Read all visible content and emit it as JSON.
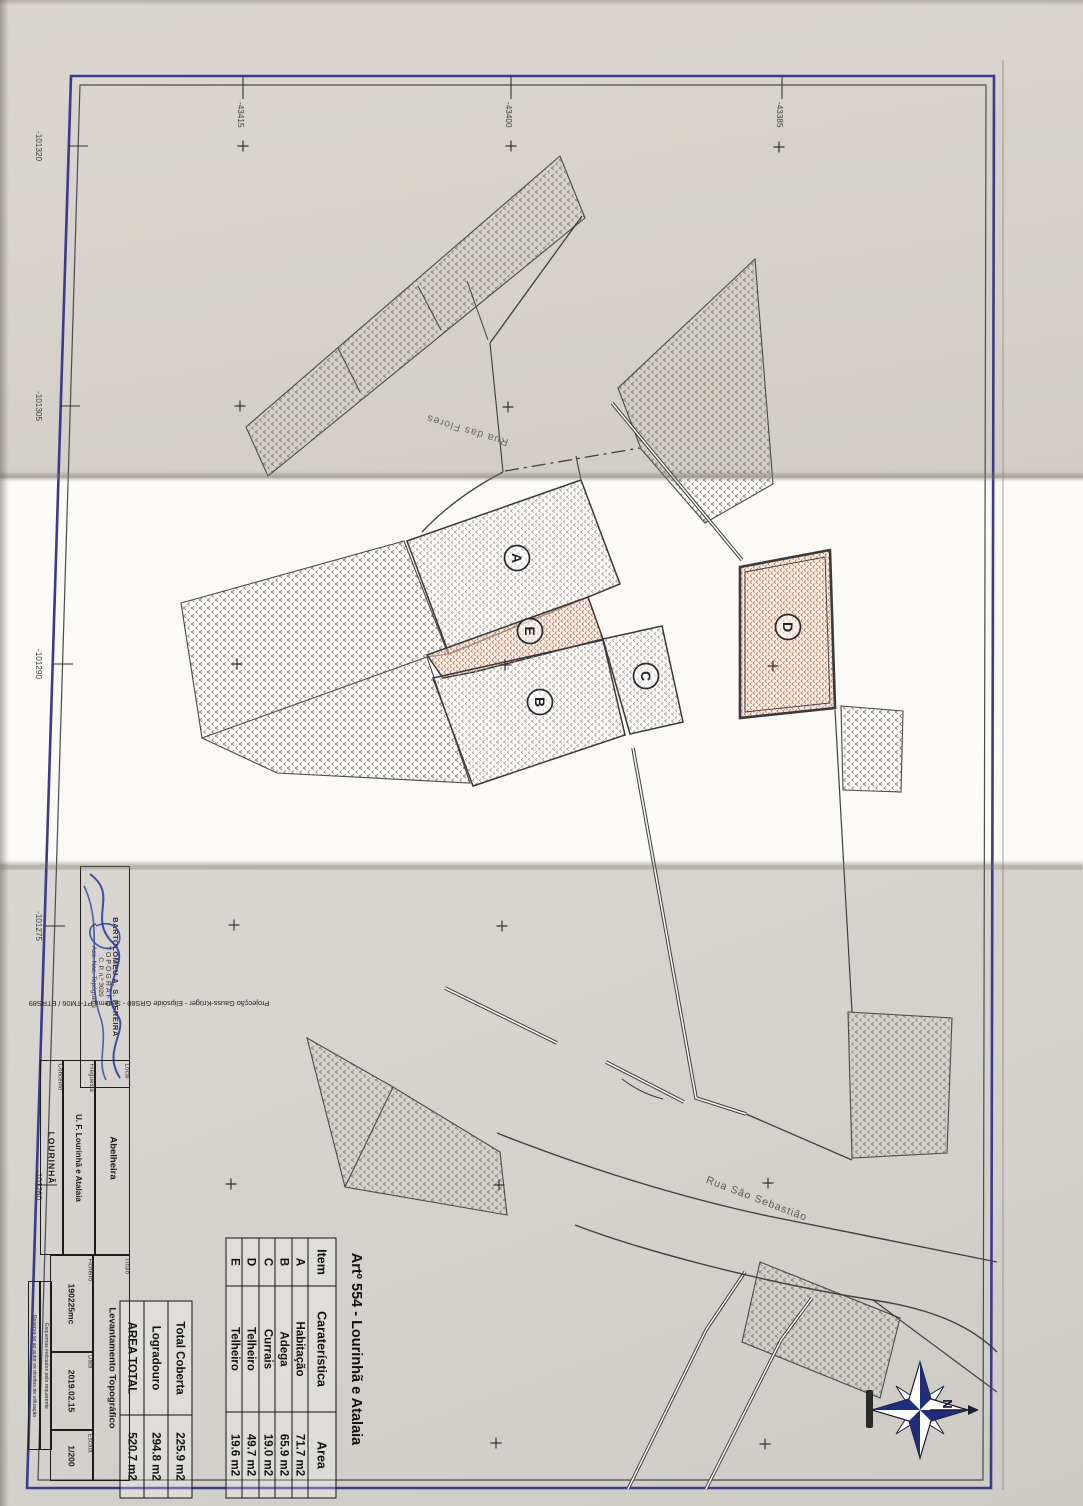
{
  "scan": {
    "plan_title": "Artº 554 - Lourinhã e Atalaia",
    "grid": {
      "left_labels": [
        "-101320",
        "-101305",
        "-101290",
        "-101275",
        "-101260"
      ],
      "top_labels": [
        "-43415",
        "-43400",
        "-43385"
      ]
    },
    "streets": {
      "flores": "Rua das Flores",
      "sebastiao": "Rua São Sebastião"
    },
    "building_labels": {
      "a": "A",
      "b": "B",
      "c": "C",
      "d": "D",
      "e": "E"
    },
    "compass": {
      "north_label": "N"
    }
  },
  "area_table": {
    "headers": {
      "item": "Item",
      "caracteristica": "Caraterística",
      "area": "Area"
    },
    "rows": [
      {
        "item": "A",
        "caracteristica": "Habitação",
        "area": "71.7 m2"
      },
      {
        "item": "B",
        "caracteristica": "Adega",
        "area": "65.9 m2"
      },
      {
        "item": "C",
        "caracteristica": "Currais",
        "area": "19.0 m2"
      },
      {
        "item": "D",
        "caracteristica": "Telheiro",
        "area": "49.7 m2"
      },
      {
        "item": "E",
        "caracteristica": "Telheiro",
        "area": "19.6 m2"
      }
    ],
    "summary": [
      {
        "label": "Total Coberta",
        "value": "225.9 m2"
      },
      {
        "label": "Logradouro",
        "value": "294.8 m2"
      },
      {
        "label": "AREA TOTAL",
        "value": "520.7 m2"
      }
    ]
  },
  "title_block": {
    "stamp": {
      "name": "BARTOLOMEU A. S. PEREIRA",
      "role": "TOPÓGRAFO",
      "number": "C. P. n.º 3029",
      "org": "Ass. Nac. Topógrafos"
    },
    "projection_note": "Projecção Gauss-Krüger - Elipsóide GRS80 - Sistema PT-TM06 / ETRS89",
    "fields": {
      "local": {
        "label": "Local",
        "value": "Abelheira"
      },
      "freguesia": {
        "label": "Freguesia",
        "value": "U. F. Lourinhã e Atalaia"
      },
      "concelho": {
        "label": "Concelho",
        "value": "LOURINHÃ"
      },
      "titulo": {
        "label": "Título",
        "value": "Levantamento Topográfico"
      },
      "ficheiro": {
        "label": "Ficheiro",
        "value": "190225mc"
      },
      "data": {
        "label": "Data",
        "value": "2019.02.15"
      },
      "escala": {
        "label": "Escala",
        "value": "1/200"
      }
    },
    "notes": {
      "note1": "Esquemas indicados pelo requerente",
      "note2": "Reserva-se ao autor os direitos de utilização"
    }
  }
}
